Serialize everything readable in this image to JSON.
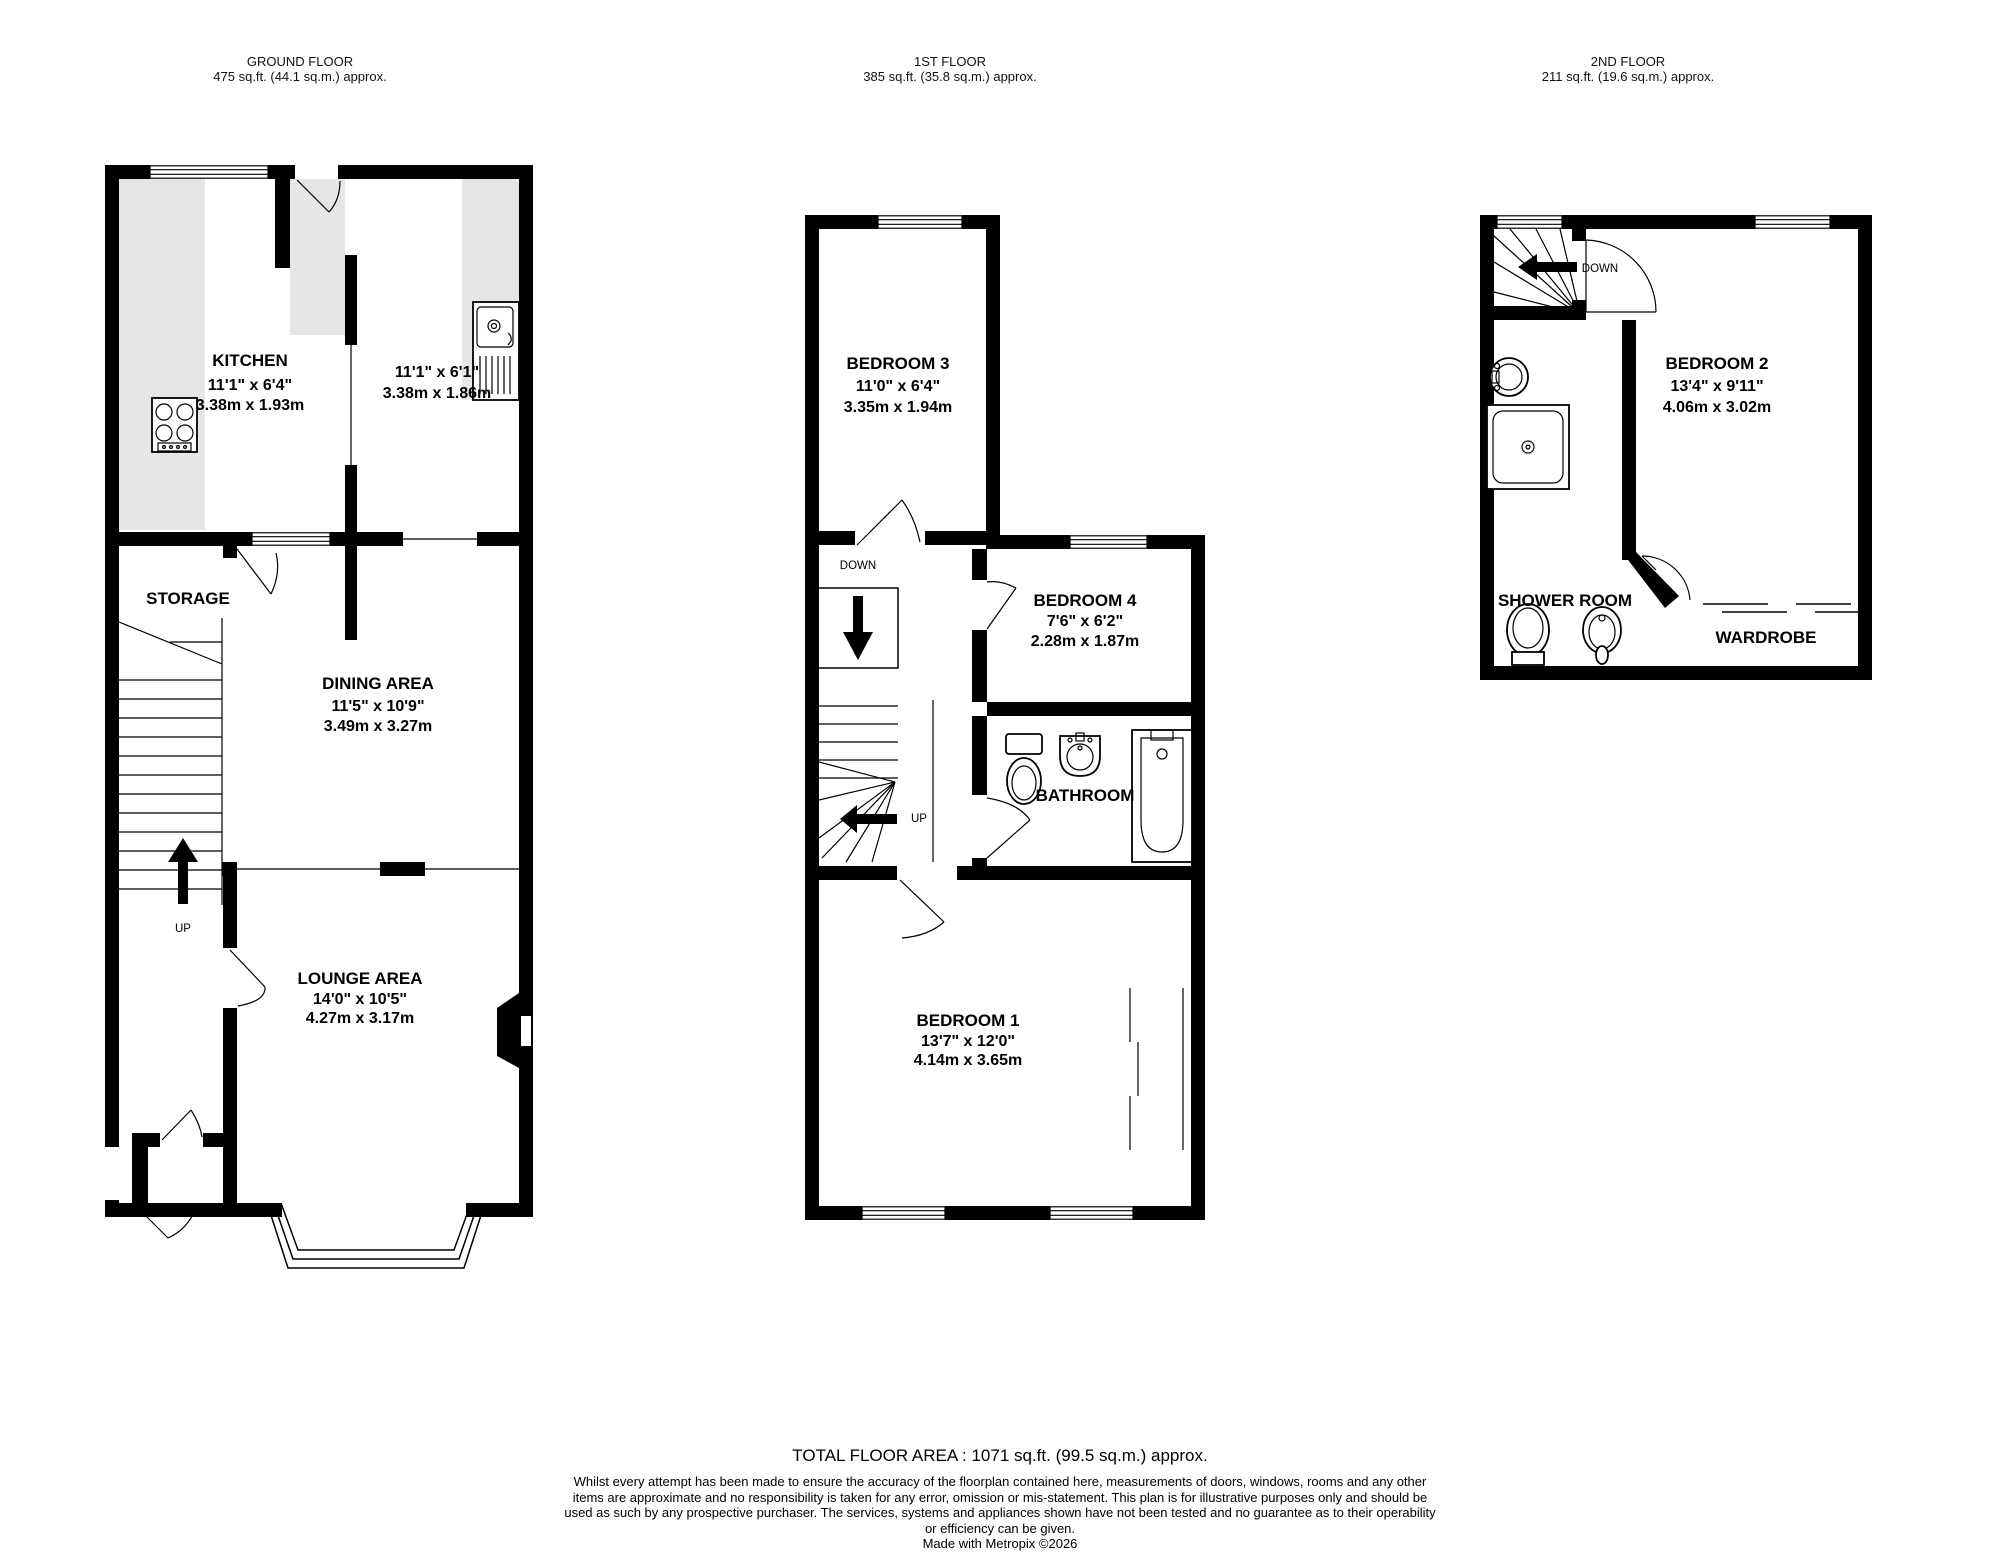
{
  "floors": [
    {
      "id": "ground",
      "title": "GROUND FLOOR",
      "area": "475 sq.ft. (44.1 sq.m.) approx."
    },
    {
      "id": "first",
      "title": "1ST FLOOR",
      "area": "385 sq.ft. (35.8 sq.m.) approx."
    },
    {
      "id": "second",
      "title": "2ND FLOOR",
      "area": "211 sq.ft. (19.6 sq.m.) approx."
    }
  ],
  "rooms": {
    "kitchen": {
      "name": "KITCHEN",
      "imperial": "11'1\"  x 6'4\"",
      "metric": "3.38m  x 1.93m"
    },
    "kitchen_area2": {
      "imperial": "11'1\"  x 6'1\"",
      "metric": "3.38m  x 1.86m"
    },
    "storage": {
      "name": "STORAGE"
    },
    "dining": {
      "name": "DINING AREA",
      "imperial": "11'5\"  x 10'9\"",
      "metric": "3.49m  x 3.27m"
    },
    "lounge": {
      "name": "LOUNGE AREA",
      "imperial": "14'0\"  x 10'5\"",
      "metric": "4.27m  x 3.17m"
    },
    "bedroom1": {
      "name": "BEDROOM 1",
      "imperial": "13'7\"  x 12'0\"",
      "metric": "4.14m  x 3.65m"
    },
    "bedroom2": {
      "name": "BEDROOM 2",
      "imperial": "13'4\"  x 9'11\"",
      "metric": "4.06m  x 3.02m"
    },
    "bedroom3": {
      "name": "BEDROOM 3",
      "imperial": "11'0\"  x 6'4\"",
      "metric": "3.35m  x 1.94m"
    },
    "bedroom4": {
      "name": "BEDROOM 4",
      "imperial": "7'6\"  x 6'2\"",
      "metric": "2.28m  x 1.87m"
    },
    "bathroom": {
      "name": "BATHROOM"
    },
    "shower_room": {
      "name": "SHOWER ROOM"
    },
    "wardrobe": {
      "name": "WARDROBE"
    }
  },
  "stairs": {
    "up_label": "UP",
    "down_label": "DOWN"
  },
  "footer": {
    "total": "TOTAL FLOOR AREA : 1071 sq.ft. (99.5 sq.m.) approx.",
    "disclaimer": "Whilst every attempt has been made to ensure the accuracy of the floorplan contained here, measurements of doors, windows, rooms and any other items are approximate and no responsibility is taken for any error, omission or mis-statement. This plan is for illustrative purposes only and should be used as such by any prospective purchaser. The services, systems and appliances shown have not been tested and no guarantee as to their operability or efficiency can be given.",
    "credit": "Made with Metropix ©2026"
  },
  "colors": {
    "wall": "#000000",
    "counter": "#e6e6e6",
    "background": "#ffffff"
  }
}
